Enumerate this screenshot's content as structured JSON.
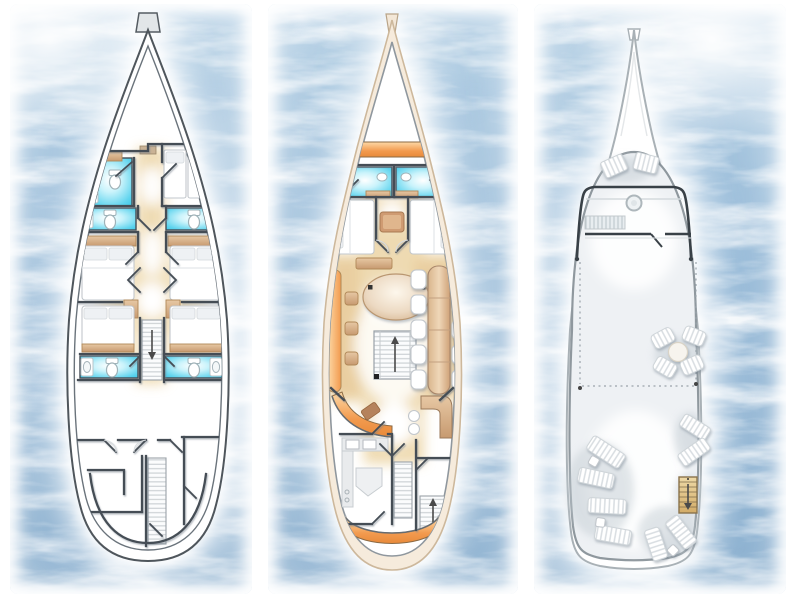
{
  "illustration": {
    "kind": "yacht-deck-plans",
    "view": "top-down",
    "orientation": "bow-up",
    "background": "sea-water",
    "deck_count": 3
  },
  "colors": {
    "sea-light": "#b7d2e6",
    "sea-mid": "#8fb5d5",
    "sea-deep": "#7aa4c8",
    "bathroom-cyan": "#3cc7e6",
    "floor-amber": "#eed9ae",
    "wood-tan": "#c79a70",
    "bench-orange": "#f29a4e",
    "hull-cream": "#f6ebdc",
    "wall-dark": "#454d55",
    "deck-gray": "#eef1f4",
    "stair-wood": "#d9b272"
  },
  "decks": [
    {
      "id": "deck-left",
      "semantic": "cabin-deck",
      "features": {
        "bathrooms": 5,
        "guest_cabins": 5,
        "double_beds": 4,
        "twin_beds": 2,
        "staircases": 2,
        "aft_rooms": 3
      }
    },
    {
      "id": "deck-middle",
      "semantic": "main-deck",
      "features": {
        "bow_sunpads": 1,
        "bathrooms": 2,
        "guest_cabins": 2,
        "oval_table": 1,
        "dining_chairs": 10,
        "lounge_stools": 3,
        "bar": 1,
        "galley": 1,
        "staircases": 3,
        "stern_bench": 1,
        "swim_steps": 2
      }
    },
    {
      "id": "deck-right",
      "semantic": "sun-deck",
      "features": {
        "bow_sunpads": 2,
        "helm_wheel": 1,
        "windshield": 1,
        "round_table": 1,
        "table_chairs": 4,
        "sun_loungers": 8,
        "side_tables": 3,
        "wood_staircase": 1
      }
    }
  ]
}
